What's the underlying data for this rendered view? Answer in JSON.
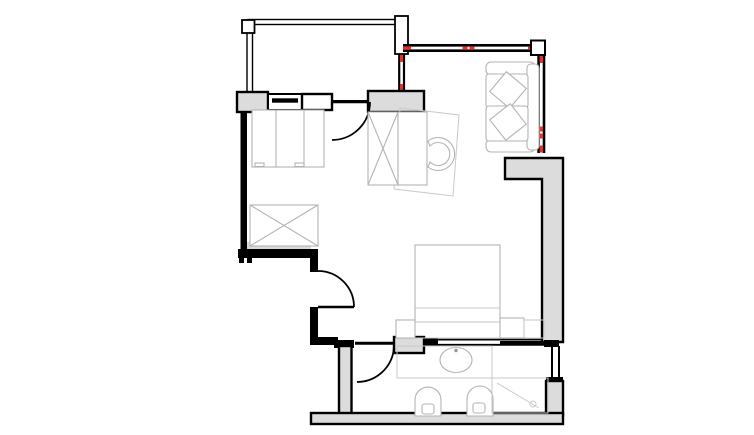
{
  "canvas": {
    "width": 754,
    "height": 435,
    "background": "#ffffff"
  },
  "colors": {
    "bg": "#ffffff",
    "ink": "#000000",
    "wall-fill": "#dcdcdc",
    "furniture": "#b3b3b3",
    "furniture-light": "#c9c9c9",
    "window-marker": "#e53229"
  },
  "drawing": {
    "type": "architectural-floor-plan",
    "symbols": [
      "balcony-railing",
      "corner-post",
      "window-wall",
      "window-marker-dash",
      "swing-door",
      "sliding-door",
      "wardrobe-x-symbol",
      "dresser",
      "desk",
      "desk-chair",
      "sofa",
      "throw-pillow",
      "bed",
      "nightstand",
      "vanity-counter",
      "sink",
      "toilet",
      "bidet",
      "shower-enclosure"
    ]
  }
}
